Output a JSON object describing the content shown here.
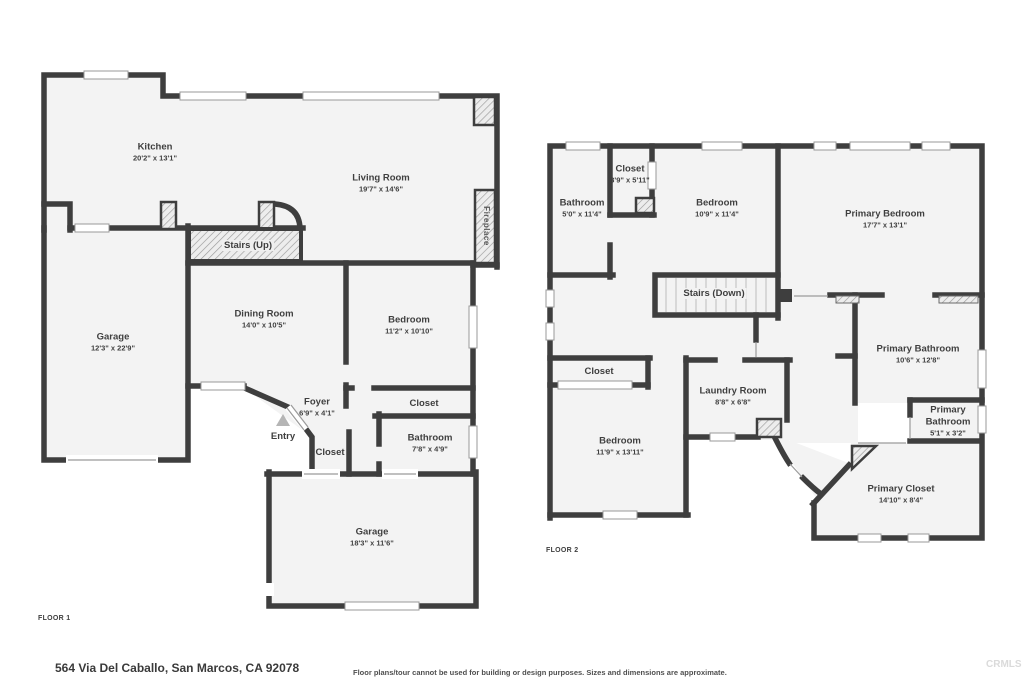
{
  "colors": {
    "wall": "#3e3e3e",
    "floor": "#f3f3f3",
    "hatch_line": "#9a9a9a"
  },
  "floor1": {
    "label": "FLOOR 1",
    "rooms": [
      {
        "name": "Kitchen",
        "dims": "20'2\" x 13'1\""
      },
      {
        "name": "Living Room",
        "dims": "19'7\" x 14'6\""
      },
      {
        "name": "Garage",
        "dims": "12'3\" x 22'9\""
      },
      {
        "name": "Dining Room",
        "dims": "14'0\" x 10'5\""
      },
      {
        "name": "Bedroom",
        "dims": "11'2\" x 10'10\""
      },
      {
        "name": "Foyer",
        "dims": "6'9\" x 4'1\""
      },
      {
        "name": "Bathroom",
        "dims": "7'8\" x 4'9\""
      },
      {
        "name": "Garage",
        "dims": "18'3\" x 11'6\""
      }
    ],
    "features": {
      "stairs": "Stairs (Up)",
      "entry": "Entry",
      "closet_a": "Closet",
      "closet_b": "Closet",
      "fireplace": "Fireplace"
    }
  },
  "floor2": {
    "label": "FLOOR 2",
    "rooms": [
      {
        "name": "Bathroom",
        "dims": "5'0\" x 11'4\""
      },
      {
        "name": "Closet",
        "dims": "3'9\" x 5'11\""
      },
      {
        "name": "Bedroom",
        "dims": "10'9\" x 11'4\""
      },
      {
        "name": "Primary Bedroom",
        "dims": "17'7\" x 13'1\""
      },
      {
        "name": "Laundry Room",
        "dims": "8'8\" x 6'8\""
      },
      {
        "name": "Primary Bathroom",
        "dims": "10'6\" x 12'8\""
      },
      {
        "name": "Primary Bathroom",
        "dims": "5'1\" x 3'2\""
      },
      {
        "name": "Bedroom",
        "dims": "11'9\" x 13'11\""
      },
      {
        "name": "Primary Closet",
        "dims": "14'10\" x 8'4\""
      }
    ],
    "features": {
      "stairs": "Stairs (Down)",
      "closet": "Closet"
    }
  },
  "footer": {
    "address": "564 Via Del Caballo, San Marcos, CA 92078",
    "disclaimer": "Floor plans/tour cannot be used for building or design purposes. Sizes and dimensions are approximate.",
    "watermark": "CRMLS"
  }
}
